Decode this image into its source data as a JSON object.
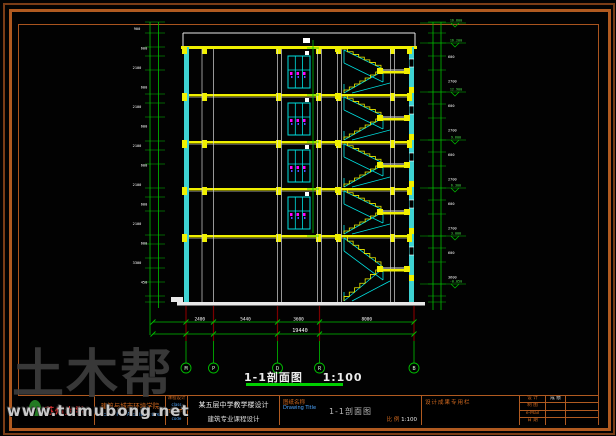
{
  "watermark": {
    "brand": "土木帮",
    "url": "www.tumubong.net"
  },
  "drawing": {
    "section_title": "1-1剖面图",
    "section_scale": "1:100",
    "total_dim": "19440",
    "segment_dims": [
      "2400",
      "5440",
      "3600",
      "8000"
    ],
    "grid_bubbles": [
      "M",
      "P",
      "D",
      "R",
      "B"
    ],
    "left_dims": [
      "900",
      "600",
      "2100",
      "600",
      "2100",
      "600",
      "2100",
      "600",
      "2100",
      "600",
      "2100",
      "600",
      "3300",
      "450"
    ],
    "right_dims": [
      "600",
      "2700",
      "600",
      "2700",
      "600",
      "2700",
      "600",
      "2700",
      "600",
      "3600"
    ],
    "elevations": [
      "16.800",
      "16.200",
      "12.900",
      "9.600",
      "6.300",
      "3.000",
      "-0.050"
    ],
    "colors": {
      "frame": "#b05a20",
      "green": "#00c000",
      "cyan": "#00e0e0",
      "yellow": "#f0f000",
      "red": "#7a0000",
      "white": "#e8e8e8",
      "magenta": "#ff00ff",
      "blue": "#5050ff",
      "gray": "#c0c0c0"
    }
  },
  "titleblock": {
    "university": "苏州大学",
    "school_cn": "建筑与城市环境学院",
    "school_en": "School of Architecture",
    "course_label_cn": "课程设计",
    "course_label_en": "class",
    "code_label_cn": "资料编号",
    "code_label_en": "code",
    "project_line1": "某五层中学教学楼设计",
    "project_line2": "建筑专业课程设计",
    "drawing_label_cn": "图纸名称",
    "drawing_label_en": "Drawing Title",
    "drawing_name": "1-1剖面图",
    "scale_label": "比 例",
    "scale_value": "1:100",
    "note": "设计成果专用栏",
    "grid_rows": [
      {
        "label": "设 计",
        "mid": "成 绩",
        "right": ""
      },
      {
        "label": "制 图",
        "mid": "",
        "right": ""
      },
      {
        "label": "e-Mail",
        "mid": "",
        "right": ""
      },
      {
        "label": "日 期",
        "mid": "",
        "right": ""
      }
    ]
  }
}
